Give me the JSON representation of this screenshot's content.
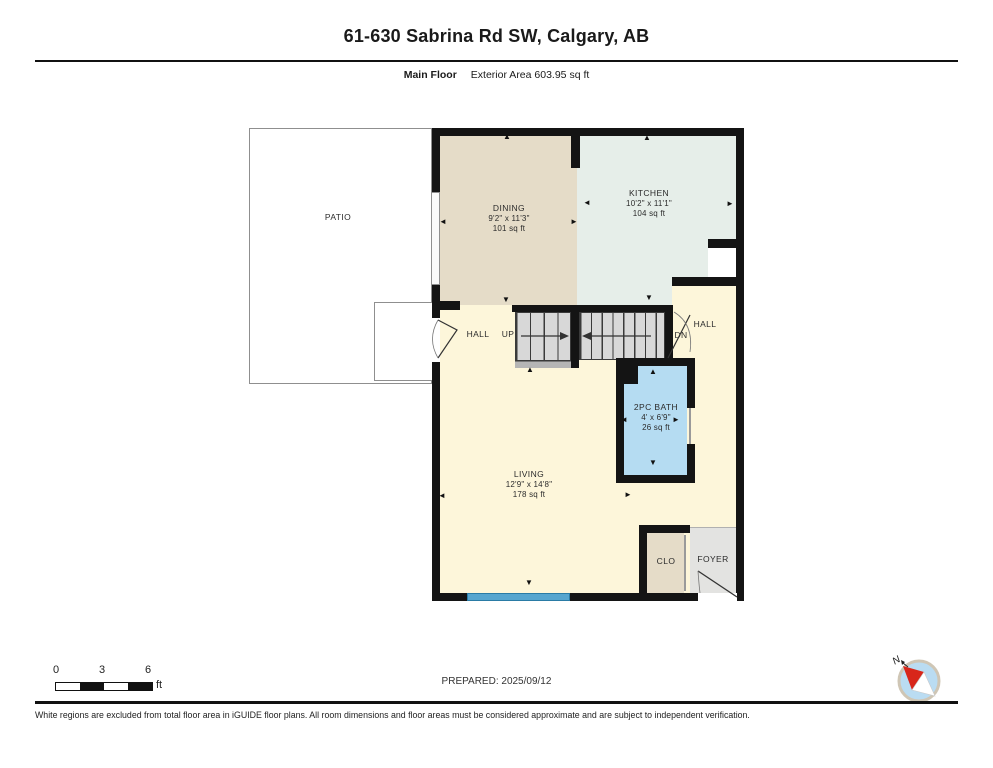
{
  "header": {
    "title": "61-630 Sabrina Rd SW, Calgary, AB",
    "floor_label": "Main Floor",
    "area_label": "Exterior Area 603.95 sq ft"
  },
  "rooms": {
    "patio": {
      "name": "PATIO"
    },
    "dining": {
      "name": "DINING",
      "dims": "9'2\" x 11'3\"",
      "area": "101 sq ft"
    },
    "kitchen": {
      "name": "KITCHEN",
      "dims": "10'2\" x 11'1\"",
      "area": "104 sq ft"
    },
    "hall_left": {
      "name": "HALL"
    },
    "hall_right": {
      "name": "HALL"
    },
    "stairs": {
      "up_label": "UP",
      "dn_label": "DN"
    },
    "bath": {
      "name": "2PC BATH",
      "dims": "4' x 6'9\"",
      "area": "26 sq ft"
    },
    "living": {
      "name": "LIVING",
      "dims": "12'9\" x 14'8\"",
      "area": "178 sq ft"
    },
    "clo": {
      "name": "CLO"
    },
    "foyer": {
      "name": "FOYER"
    }
  },
  "icons": {
    "up": "▲",
    "down": "▼",
    "left": "◄",
    "right": "►"
  },
  "scale_bar": {
    "ticks": [
      "0",
      "3",
      "6"
    ],
    "unit": "ft"
  },
  "prepared": "PREPARED: 2025/09/12",
  "compass": {
    "label": "N"
  },
  "footer": "White regions are excluded from total floor area in iGUIDE floor plans. All room dimensions and floor areas must be considered approximate and are subject to independent verification.",
  "colors": {
    "wall": "#141414",
    "dining": "#e5dcc8",
    "kitchen": "#e6eee9",
    "living": "#fdf6da",
    "bath": "#b5dcf2",
    "foyer": "#e3e3e1",
    "clo": "#e5dcc8",
    "stairs": "#d8d8d8",
    "window": "#56a5cf",
    "compass_fill": "#badcf2",
    "compass_needle": "#d8261a"
  }
}
